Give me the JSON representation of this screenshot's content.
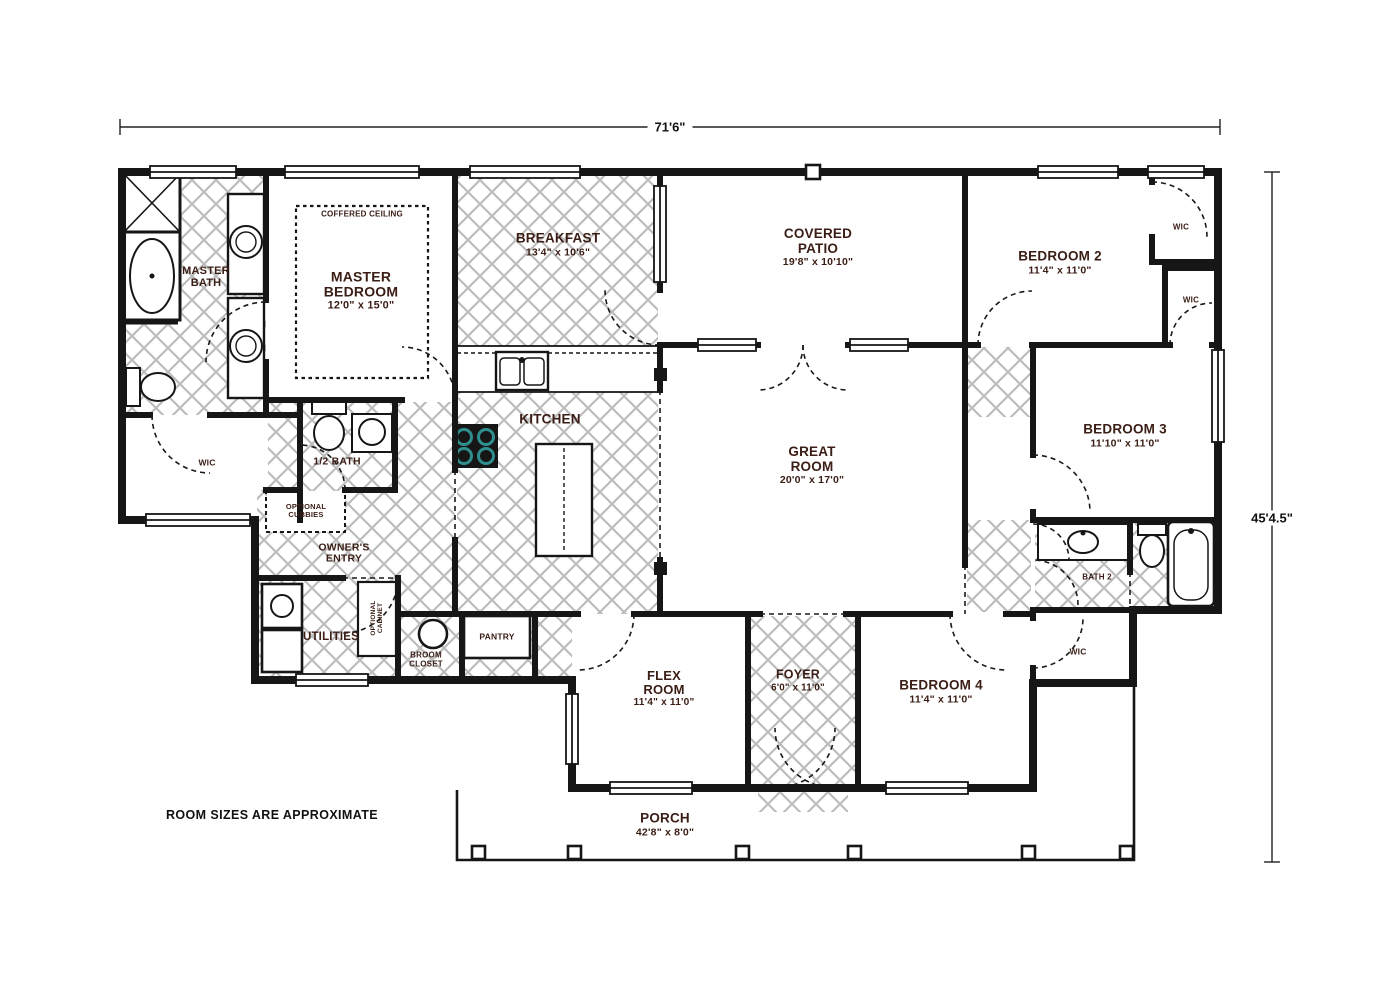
{
  "plan": {
    "note": "ROOM SIZES ARE APPROXIMATE",
    "dimensions": {
      "width": "71'6\"",
      "height": "45'4.5\""
    },
    "rooms": {
      "master_bedroom": {
        "name": "MASTER\nBEDROOM",
        "size": "12'0\" x 15'0\"",
        "feature": "COFFERED CEILING"
      },
      "master_bath": {
        "name": "MASTER\nBATH"
      },
      "wic_master": {
        "name": "WIC"
      },
      "half_bath": {
        "name": "1/2 BATH"
      },
      "optional_cubbies": {
        "name": "OPTIONAL\nCUBBIES"
      },
      "owners_entry": {
        "name": "OWNER'S\nENTRY"
      },
      "utilities": {
        "name": "UTILITIES"
      },
      "optional_cabinet": {
        "name": "OPTIONAL\nCABINET"
      },
      "broom_closet": {
        "name": "BROOM\nCLOSET"
      },
      "pantry": {
        "name": "PANTRY"
      },
      "kitchen": {
        "name": "KITCHEN"
      },
      "breakfast": {
        "name": "BREAKFAST",
        "size": "13'4\" x 10'6\""
      },
      "covered_patio": {
        "name": "COVERED\nPATIO",
        "size": "19'8\" x 10'10\""
      },
      "great_room": {
        "name": "GREAT\nROOM",
        "size": "20'0\" x 17'0\""
      },
      "bedroom2": {
        "name": "BEDROOM 2",
        "size": "11'4\" x 11'0\""
      },
      "wic_bed2_a": {
        "name": "WIC"
      },
      "wic_bed2_b": {
        "name": "WIC"
      },
      "bedroom3": {
        "name": "BEDROOM 3",
        "size": "11'10\" x 11'0\""
      },
      "bath2": {
        "name": "BATH 2"
      },
      "wic_bed4": {
        "name": "WIC"
      },
      "flex_room": {
        "name": "FLEX\nROOM",
        "size": "11'4\" x 11'0\""
      },
      "foyer": {
        "name": "FOYER",
        "size": "6'0\" x 11'0\""
      },
      "bedroom4": {
        "name": "BEDROOM 4",
        "size": "11'4\" x 11'0\""
      },
      "porch": {
        "name": "PORCH",
        "size": "42'8\" x 8'0\""
      }
    },
    "colors": {
      "wall": "#161616",
      "label": "#3a1d15",
      "hatch": "#bcbcbc",
      "cooktop_accent": "#2f8f8f"
    }
  }
}
